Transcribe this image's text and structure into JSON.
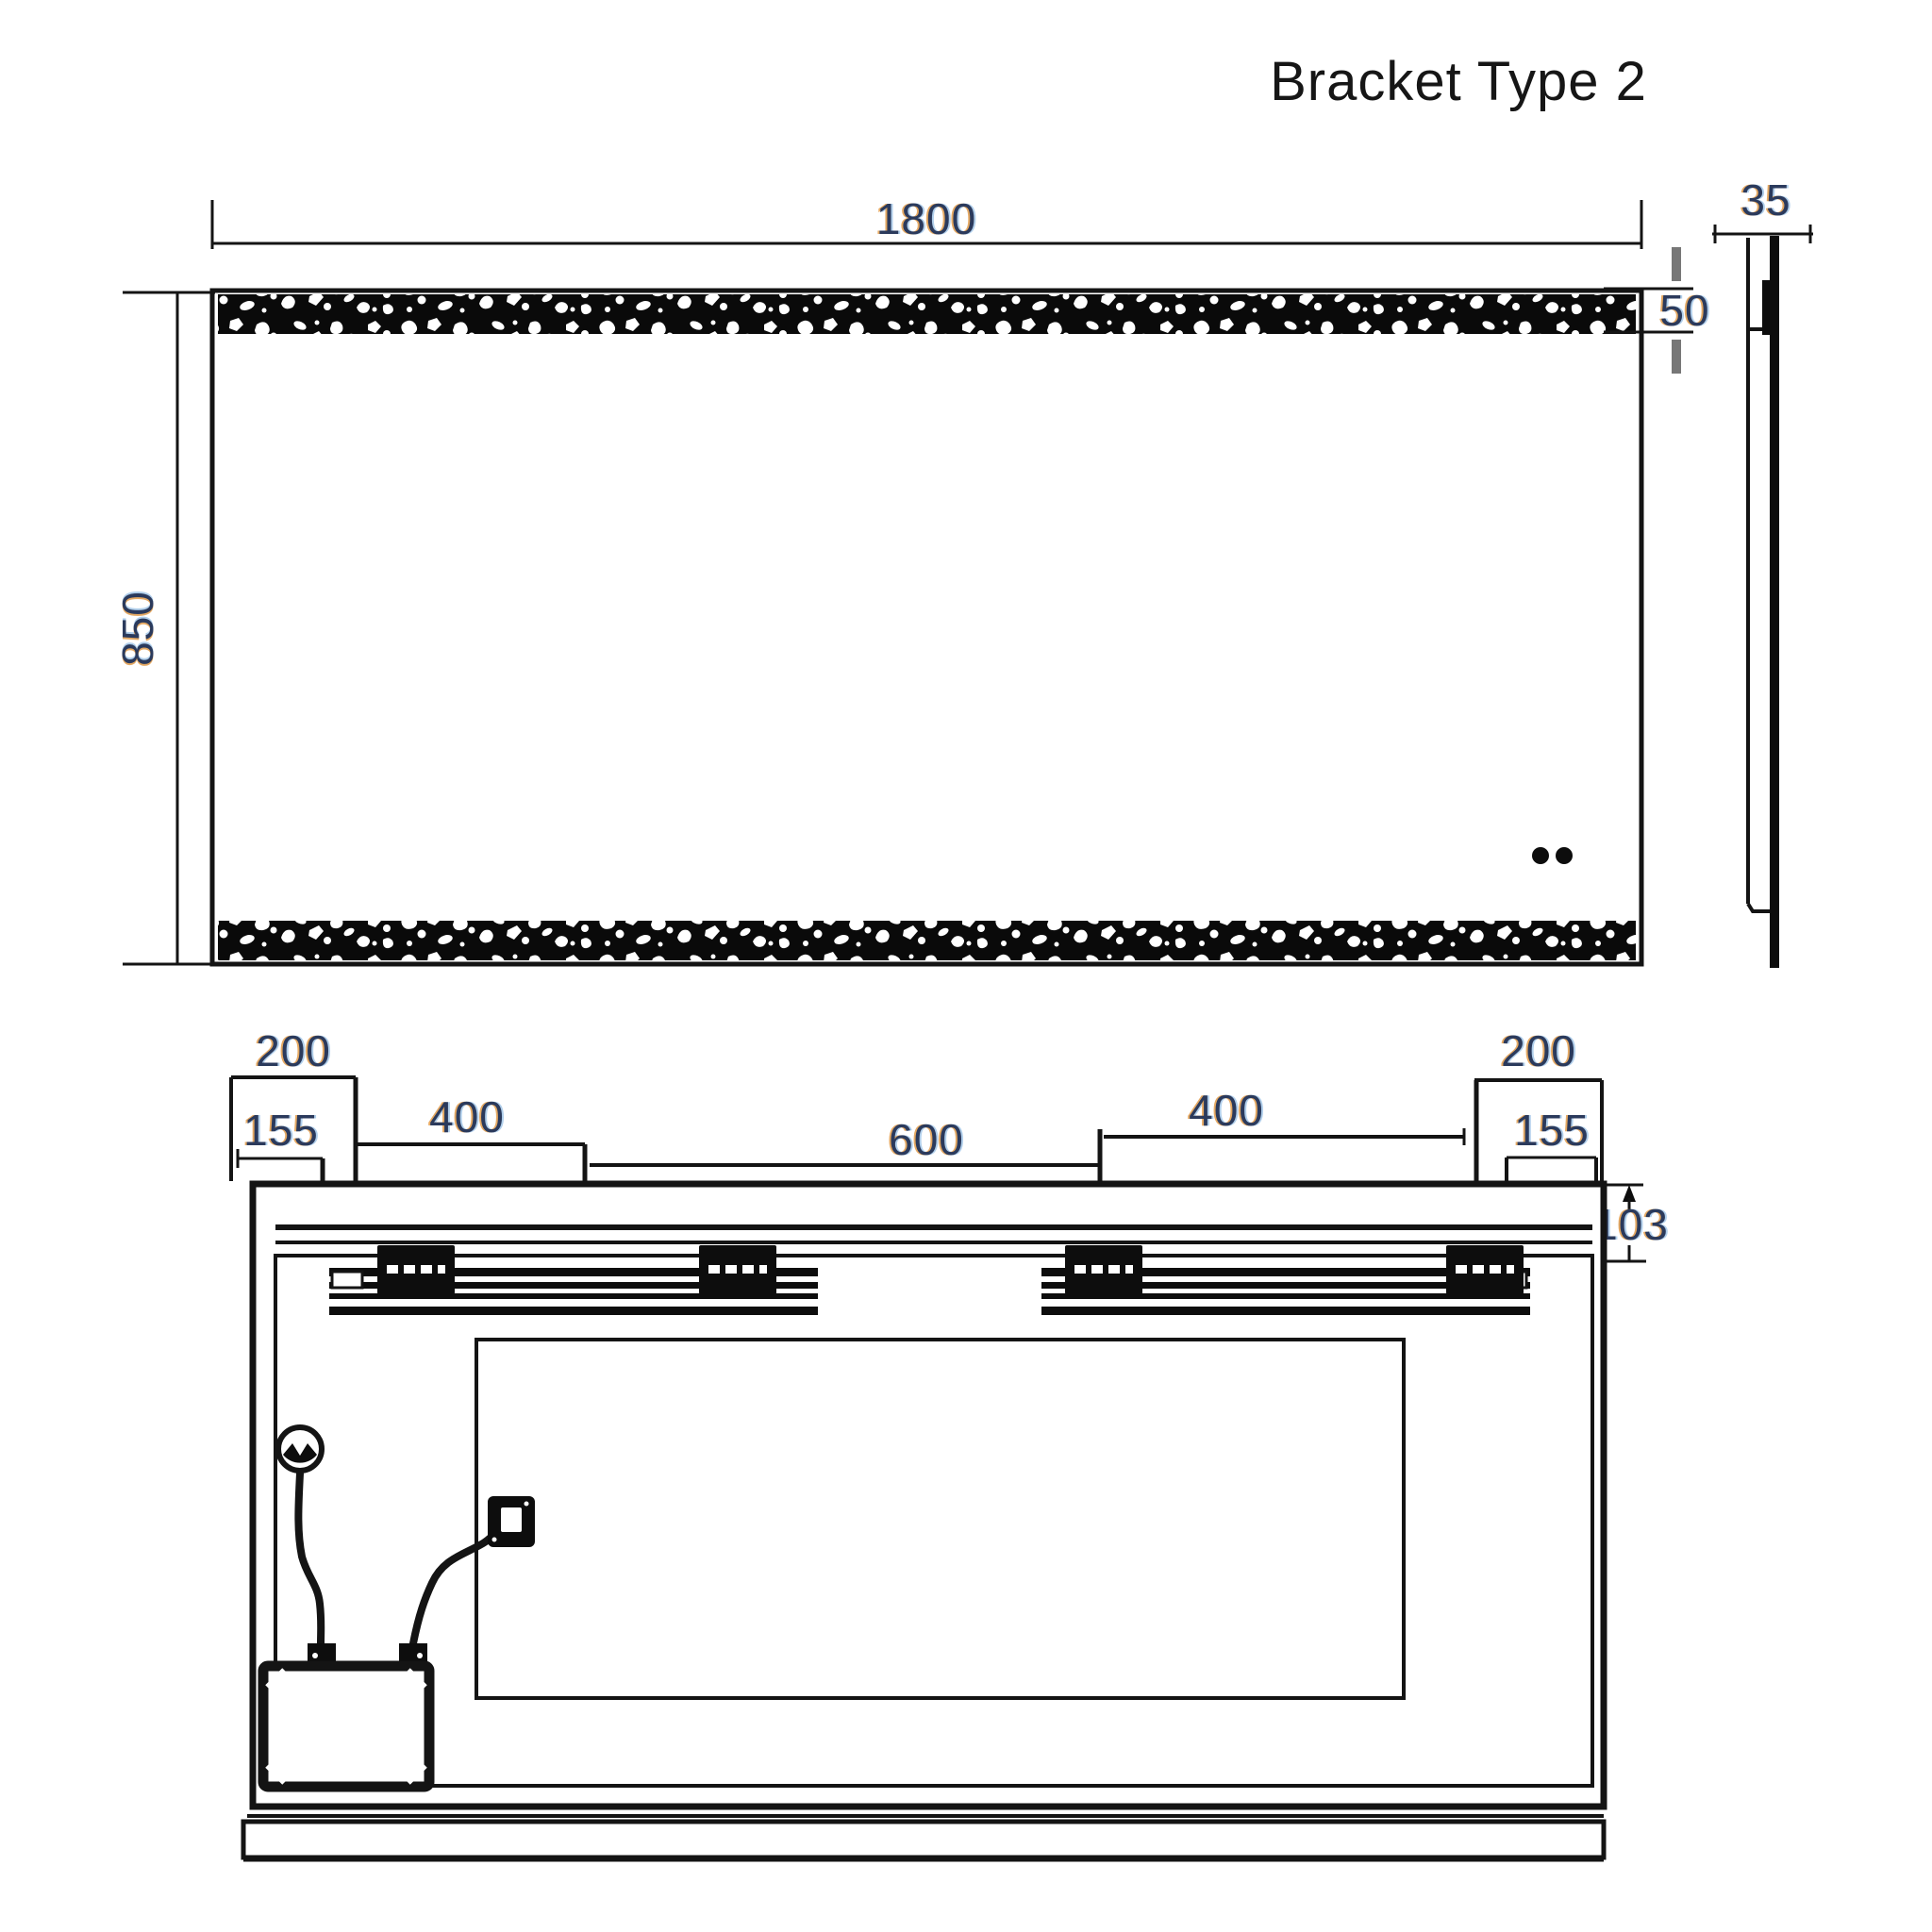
{
  "title": "Bracket Type 2",
  "colors": {
    "line": "#141414",
    "dim_text": "#2b3a5c"
  },
  "front_view": {
    "width_mm": "1800",
    "height_mm": "850",
    "strip_height_mm": "50"
  },
  "side_view": {
    "depth_mm": "35"
  },
  "rear_view": {
    "left_bracket_width_mm": "200",
    "left_edge_offset_mm": "155",
    "left_span_mm": "400",
    "center_span_mm": "600",
    "right_span_mm": "400",
    "right_bracket_width_mm": "200",
    "right_edge_offset_mm": "155",
    "rail_drop_mm": "103"
  }
}
